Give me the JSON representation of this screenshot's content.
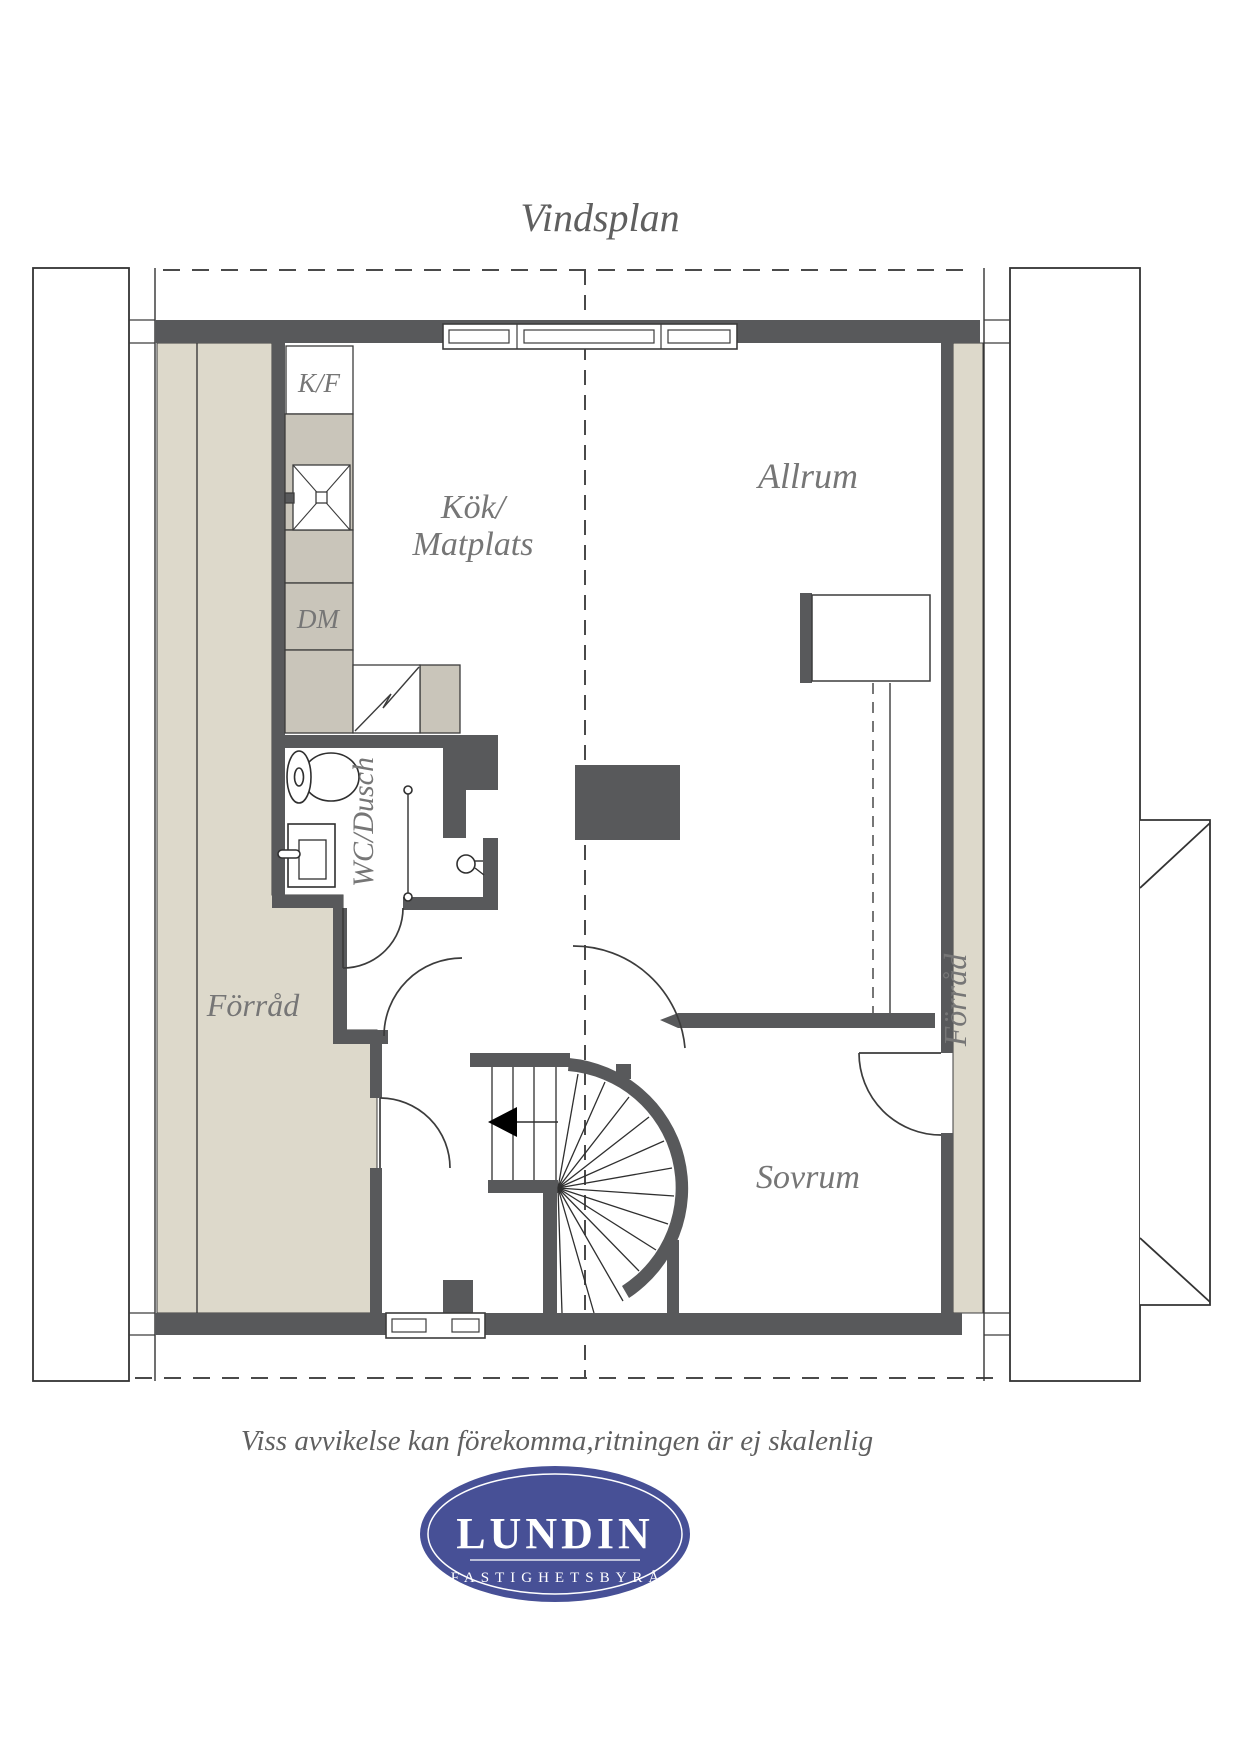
{
  "title": "Vindsplan",
  "disclaimer": "Viss avvikelse kan förekomma,ritningen är ej skalenlig",
  "rooms": {
    "kitchen_line1": "Kök/",
    "kitchen_line2": "Matplats",
    "living": "Allrum",
    "bedroom": "Sovrum",
    "storage_left": "Förråd",
    "storage_right": "Förråd",
    "bathroom": "WC/Dusch"
  },
  "appliances": {
    "fridge_freezer": "K/F",
    "dishwasher": "DM"
  },
  "logo": {
    "name": "LUNDIN",
    "tagline": "FASTIGHETSBYRÅ"
  },
  "colors": {
    "wall": "#58595b",
    "storage_fill": "#ddd9cb",
    "counter_fill": "#c9c5ba",
    "label_gray": "#767676",
    "line": "#3c3c3c",
    "logo_blue": "#475096"
  }
}
